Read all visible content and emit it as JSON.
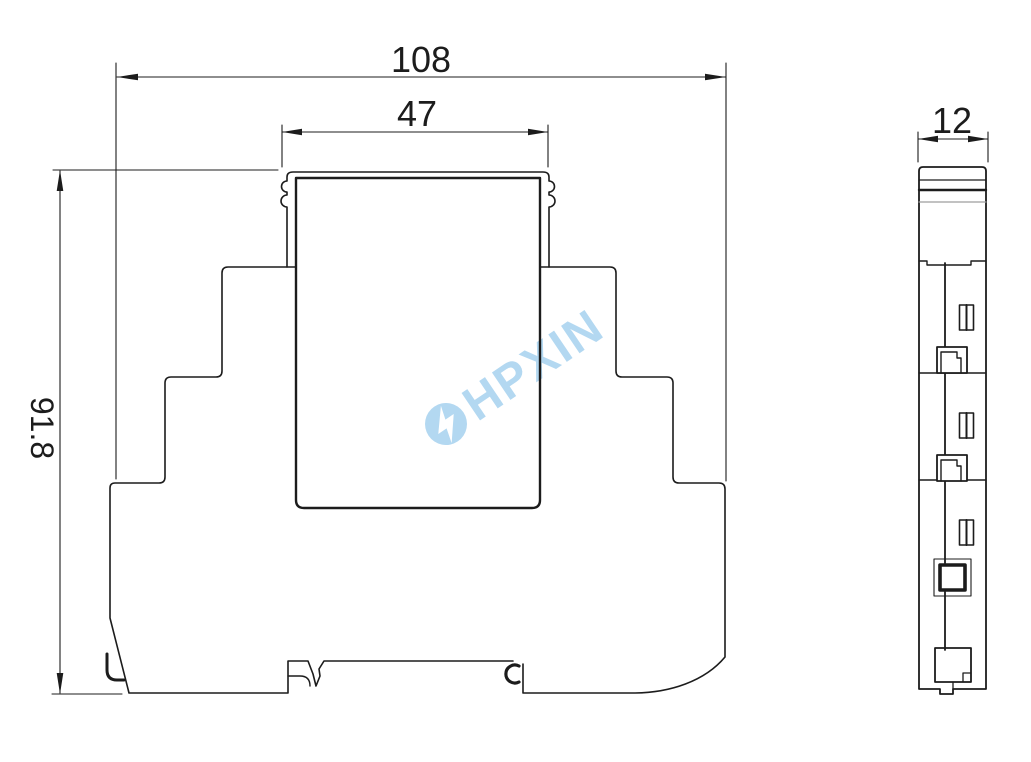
{
  "page": {
    "background": "#ffffff",
    "line_color": "#1c1c1c",
    "divider_gray": "#9d9d9d"
  },
  "views": {
    "front_view": {
      "dimensions": {
        "overall_width": "108",
        "top_width": "47",
        "height": "91.8"
      }
    },
    "side_view": {
      "dimensions": {
        "depth": "12"
      }
    }
  },
  "watermark": {
    "text": "HPXIN",
    "color": "#b3d8f1",
    "bolt_color": "#ffffff",
    "icon": "lightning-bolt-circle-icon"
  }
}
